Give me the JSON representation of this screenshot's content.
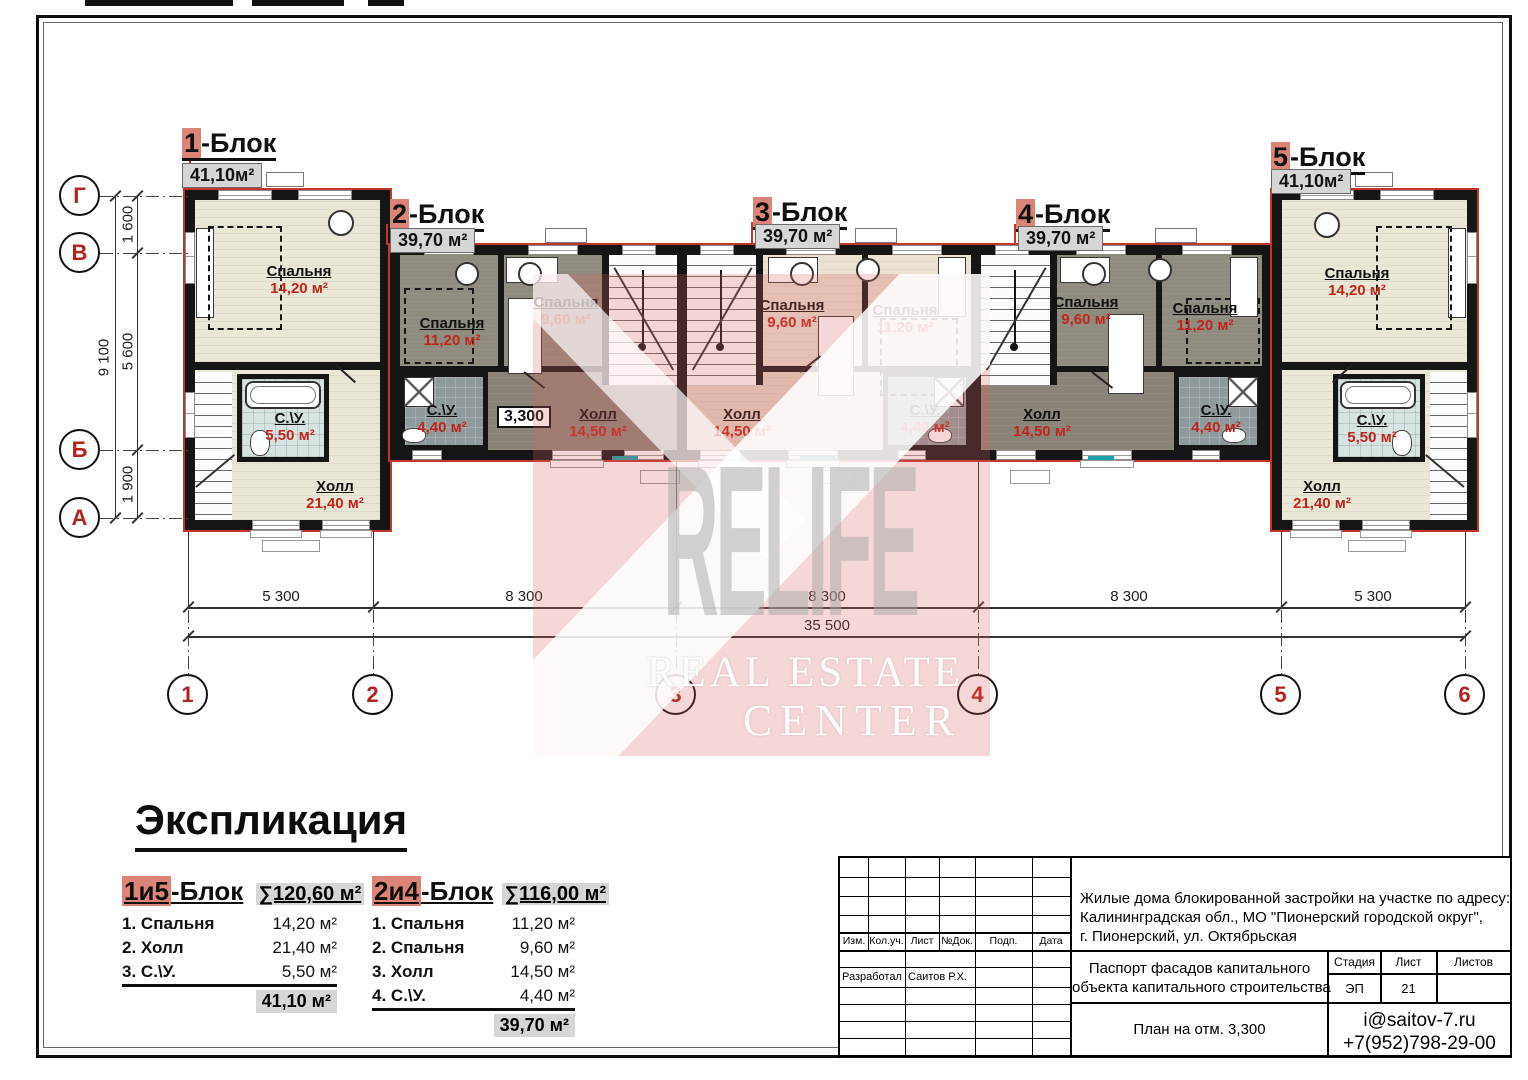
{
  "watermark": {
    "big": "RELIFE",
    "line1": "REAL ESTATE",
    "line2": "CENTER"
  },
  "blocks": [
    {
      "digit": "1",
      "suffix": "-Блок",
      "area": "41,10м²"
    },
    {
      "digit": "2",
      "suffix": "-Блок",
      "area": "39,70 м²"
    },
    {
      "digit": "3",
      "suffix": "-Блок",
      "area": "39,70 м²"
    },
    {
      "digit": "4",
      "suffix": "-Блок",
      "area": "39,70 м²"
    },
    {
      "digit": "5",
      "suffix": "-Блок",
      "area": "41,10м²"
    }
  ],
  "rooms": {
    "b1": {
      "bedroom": {
        "name": "Спальня",
        "area": "14,20 м²"
      },
      "wc": {
        "name": "С.\\У.",
        "area": "5,50 м²"
      },
      "hall": {
        "name": "Холл",
        "area": "21,40 м²"
      }
    },
    "b2": {
      "bed1": {
        "name": "Спальня",
        "area": "11,20 м²"
      },
      "bed2": {
        "name": "Спальня",
        "area": "9,60 м²"
      },
      "wc": {
        "name": "С.\\У.",
        "area": "4,40 м²"
      },
      "hall": {
        "name": "Холл",
        "area": "14,50 м²"
      }
    },
    "b3": {
      "bed1": {
        "name": "Спальня",
        "area": "9,60 м²"
      },
      "bed2": {
        "name": "Спальня",
        "area": "11,20 м²"
      },
      "wc": {
        "name": "С.\\У.",
        "area": "4,40 м²"
      },
      "hall": {
        "name": "Холл",
        "area": "14,50 м²"
      }
    },
    "b4": {
      "bed1": {
        "name": "Спальня",
        "area": "9,60 м²"
      },
      "bed2": {
        "name": "Спальня",
        "area": "11,20 м²"
      },
      "wc": {
        "name": "С.\\У.",
        "area": "4,40 м²"
      },
      "hall": {
        "name": "Холл",
        "area": "14,50 м²"
      }
    },
    "b5": {
      "bedroom": {
        "name": "Спальня",
        "area": "14,20 м²"
      },
      "wc": {
        "name": "С.\\У.",
        "area": "5,50 м²"
      },
      "hall": {
        "name": "Холл",
        "area": "21,40 м²"
      }
    }
  },
  "elevation": "3,300",
  "axes": {
    "rows": [
      "Г",
      "В",
      "Б",
      "А"
    ],
    "row_dims": [
      "1 600",
      "5 600",
      "1 900"
    ],
    "row_total": "9 100",
    "cols": [
      "1",
      "2",
      "3",
      "4",
      "5",
      "6"
    ],
    "col_dims": [
      "5 300",
      "8 300",
      "8 300",
      "8 300",
      "5 300"
    ],
    "col_total": "35 500"
  },
  "explication": {
    "title": "Экспликация",
    "tables": [
      {
        "hl": "1и5",
        "suffix": "-Блок",
        "sum": "∑120,60 м²",
        "rows": [
          [
            "1.",
            "Спальня",
            "14,20 м²"
          ],
          [
            "2.",
            "Холл",
            "21,40 м²"
          ],
          [
            "3.",
            "С.\\У.",
            "5,50 м²"
          ]
        ],
        "total": "41,10 м²"
      },
      {
        "hl": "2и4",
        "suffix": "-Блок",
        "sum": "∑116,00 м²",
        "rows": [
          [
            "1.",
            "Спальня",
            "11,20 м²"
          ],
          [
            "2.",
            "Спальня",
            "9,60 м²"
          ],
          [
            "3.",
            "Холл",
            "14,50 м²"
          ],
          [
            "4.",
            "С.\\У.",
            "4,40 м²"
          ]
        ],
        "total": "39,70 м²"
      }
    ]
  },
  "titleblock": {
    "cols": [
      "Изм.",
      "Кол.уч.",
      "Лист",
      "№Док.",
      "Подп.",
      "Дата"
    ],
    "address": [
      "Жилые дома блокированной застройки на участке по адресу:",
      "Калининградская обл., МО \"Пионерский городской округ\",",
      "г. Пионерский, ул. Октябрьская"
    ],
    "dev_label": "Разработал",
    "dev_name": "Саитов Р.Х.",
    "doc_line1": "Паспорт фасадов капитального",
    "doc_line2": "объекта капитального строительства",
    "stage_label": "Стадия",
    "sheet_label": "Лист",
    "sheets_label": "Листов",
    "stage": "ЭП",
    "sheet_no": "21",
    "sheets": "",
    "caption": "План на отм. 3,300",
    "email": "i@saitov-7.ru",
    "phone": "+7(952)798-29-00"
  }
}
